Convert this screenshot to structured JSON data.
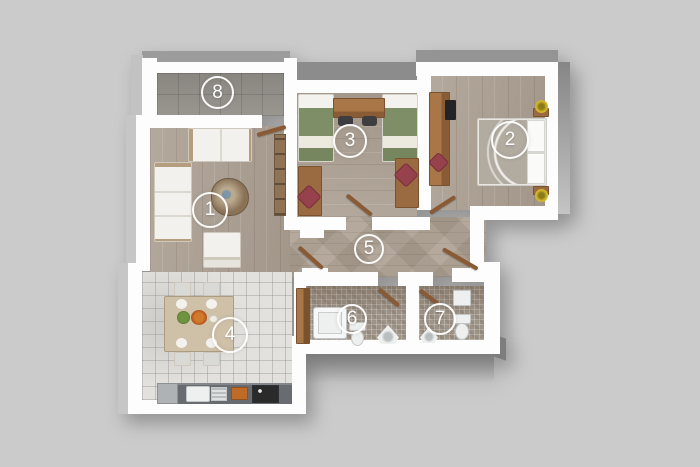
{
  "title": "apartment-floor-plan-3d-top-view",
  "background_color": "#cbcbcb",
  "rooms": [
    {
      "number": "1",
      "name": "living-room"
    },
    {
      "number": "2",
      "name": "bedroom-double"
    },
    {
      "number": "3",
      "name": "bedroom-twin"
    },
    {
      "number": "4",
      "name": "kitchen-dining"
    },
    {
      "number": "5",
      "name": "hallway"
    },
    {
      "number": "6",
      "name": "bathroom"
    },
    {
      "number": "7",
      "name": "toilet"
    },
    {
      "number": "8",
      "name": "balcony"
    }
  ],
  "palette": {
    "wall": "#fdfdfd",
    "wood_floor": "#ab9f91",
    "balcony_tile": "#94908a",
    "kitchen_tile": "#e2e1de",
    "mosaic_tile": "#9d9386",
    "bedding_green": "#7e8e66",
    "furniture_wood": "#9a6a41",
    "accent_red": "#96424d",
    "counter_gray": "#686c70",
    "plant_yellow": "#d8bb2e",
    "marker_ring": "#ffffff"
  }
}
